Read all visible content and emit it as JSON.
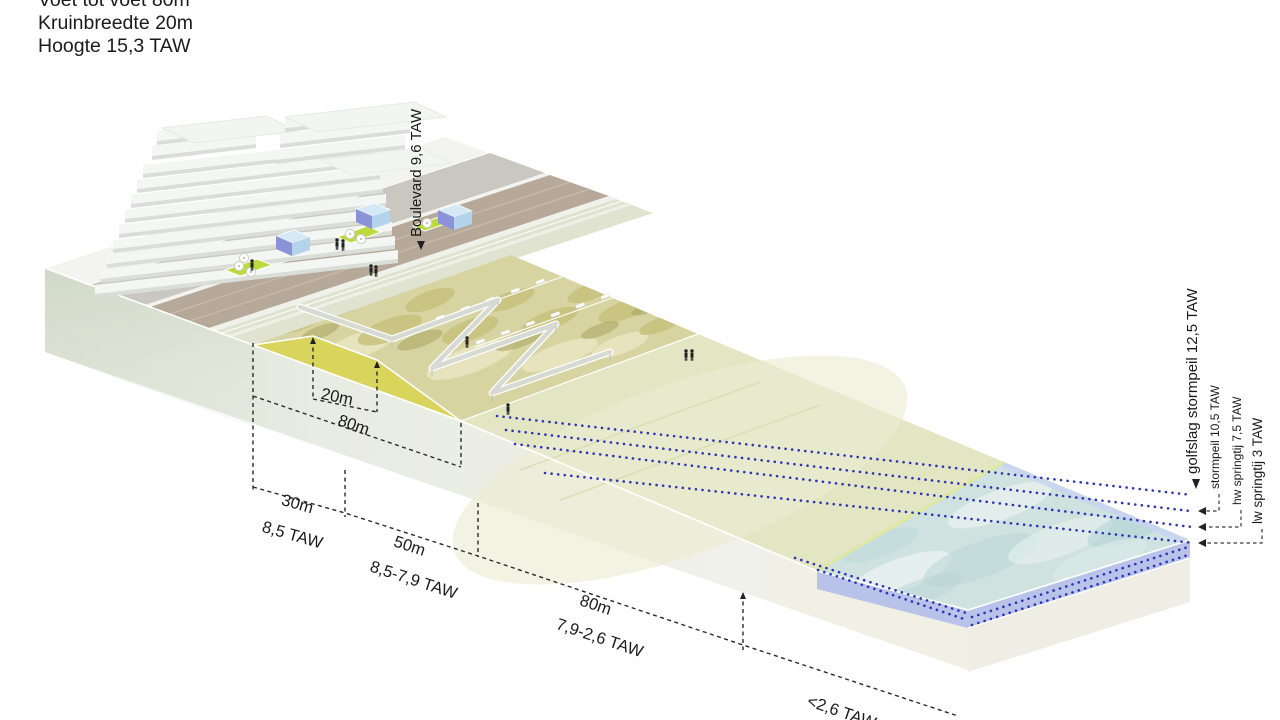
{
  "title_block": {
    "lines": [
      "Voet tot voet 80m",
      "Kruinbreedte 20m",
      "Hoogte 15,3 TAW"
    ]
  },
  "boulevard_label": {
    "text": "Boulevard 9,6 TAW"
  },
  "water_level_labels": [
    {
      "name": "golfslag-stormpeil",
      "text": "golfslag stormpeil 12,5 TAW"
    },
    {
      "name": "stormpeil",
      "text": "stormpeil 10,5 TAW"
    },
    {
      "name": "hw-springtij",
      "text": "hw springtij 7,5 TAW"
    },
    {
      "name": "lw-springtij",
      "text": "lw springtij 3 TAW"
    }
  ],
  "dimensions": {
    "crest_width": {
      "length": "20m"
    },
    "dune_footprint": {
      "length": "80m"
    },
    "seg_boulevard": {
      "length": "30m",
      "level": "8,5 TAW"
    },
    "seg_dune": {
      "length": "50m",
      "level": "8,5-7,9 TAW"
    },
    "seg_beach": {
      "length": "80m",
      "level": "7,9-2,6 TAW"
    },
    "seg_offshore": {
      "level": "<2,6 TAW"
    }
  },
  "colors": {
    "water_level_dots": "#2e34b8",
    "dune_sand_face": "#d8d45c",
    "water_layer_lavender": "#b9c2e8",
    "sea_surface": "#cfe2e0",
    "beach": "#e3e6c3",
    "glass_pavilion": "#8a92d8",
    "grass_patch": "#bcda3e",
    "promenade_brown": "#b6a99a"
  }
}
